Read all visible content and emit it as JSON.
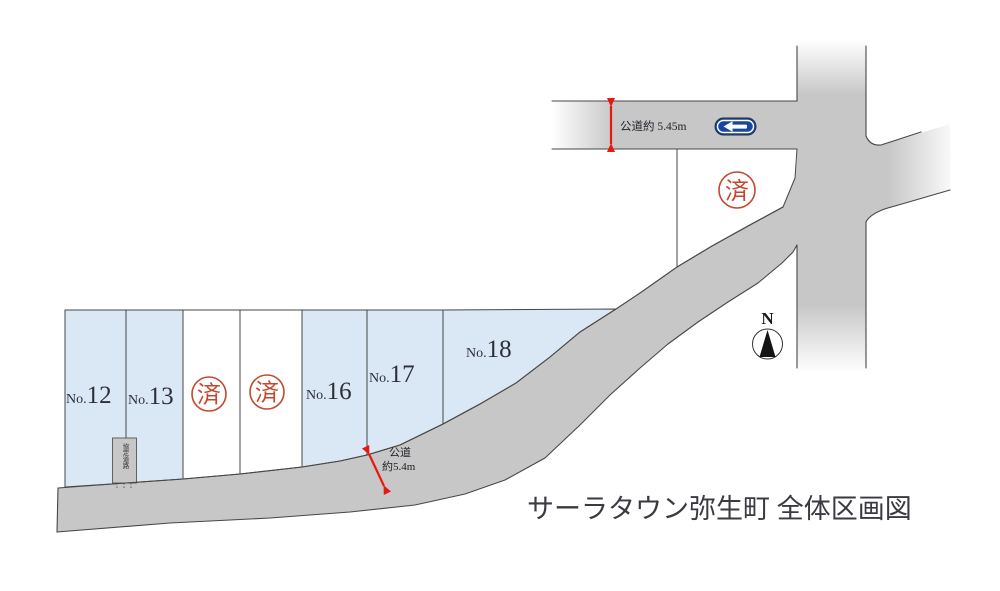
{
  "title": "サーラタウン弥生町 全体区画図",
  "compass": {
    "label": "N"
  },
  "dimensions": {
    "top_road": {
      "label": "公道約 5.45m"
    },
    "front_road": {
      "line1": "公道",
      "line2": "約5.4m"
    }
  },
  "stamps": {
    "sold_label": "済"
  },
  "structure": {
    "label": "協定道路"
  },
  "signs": {
    "one_way": {
      "type": "one-way-left-arrow"
    }
  },
  "lots": [
    {
      "prefix": "No.",
      "number": "12",
      "status": "available"
    },
    {
      "prefix": "No.",
      "number": "13",
      "status": "available"
    },
    {
      "prefix": "",
      "number": "",
      "status": "sold"
    },
    {
      "prefix": "",
      "number": "",
      "status": "sold"
    },
    {
      "prefix": "No.",
      "number": "16",
      "status": "available"
    },
    {
      "prefix": "No.",
      "number": "17",
      "status": "available"
    },
    {
      "prefix": "No.",
      "number": "18",
      "status": "available"
    },
    {
      "prefix": "",
      "number": "",
      "status": "sold"
    }
  ],
  "colors": {
    "road_fill": "#c7c7c7",
    "lot_fill": "#d9e8f4",
    "sold_white": "#ffffff",
    "stamp": "#c5472e",
    "arrow": "#e6190e",
    "sign_blue": "#17479e",
    "line": "#474747",
    "text": "#2e2e38"
  }
}
